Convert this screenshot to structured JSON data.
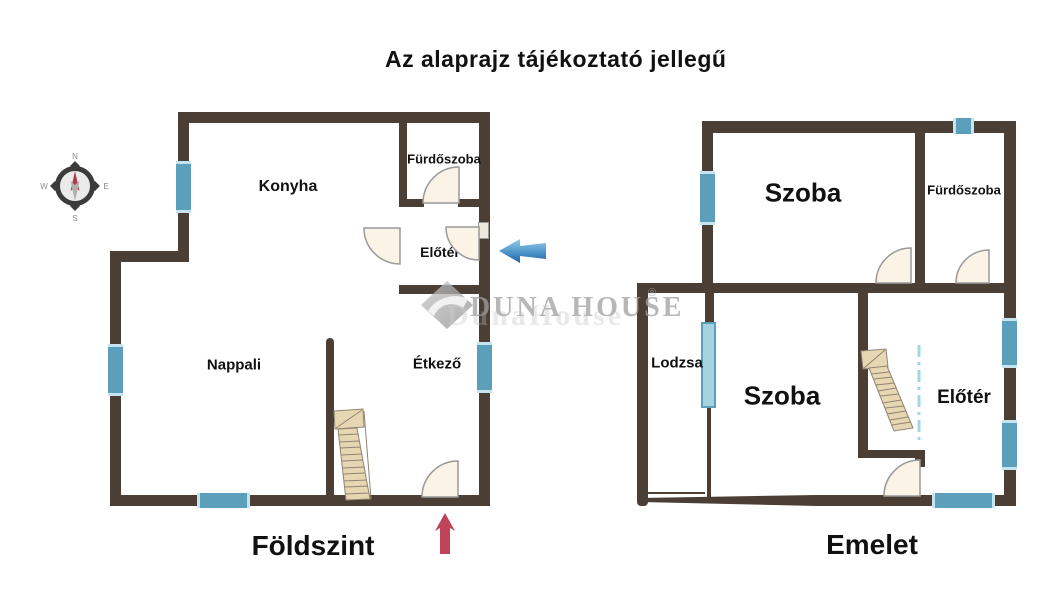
{
  "title": "Az alaprajz tájékoztató jellegű",
  "compass": {
    "north": "N",
    "east": "E",
    "south": "S",
    "west": "W"
  },
  "watermark": {
    "brand": "DUNA HOUSE",
    "reg": "®",
    "ghost": "DunaHouse"
  },
  "floors": [
    {
      "name": "Földszint",
      "rooms": [
        {
          "label": "Konyha"
        },
        {
          "label": "Fürdőszoba"
        },
        {
          "label": "Előtér"
        },
        {
          "label": "Nappali"
        },
        {
          "label": "Étkező"
        }
      ]
    },
    {
      "name": "Emelet",
      "rooms": [
        {
          "label": "Szoba"
        },
        {
          "label": "Fürdőszoba"
        },
        {
          "label": "Lodzsa"
        },
        {
          "label": "Szoba"
        },
        {
          "label": "Előtér"
        }
      ]
    }
  ],
  "colors": {
    "wall": "#4a3e35",
    "window_fill": "#5b9fba",
    "window_edge": "#c6e4ef",
    "window_light": "#a6d3e2",
    "door_fill": "#faf3e6",
    "door_stroke": "#9a9a9a",
    "stair_fill": "#e6d7b2",
    "stair_stroke": "#8f8472",
    "dash_line": "#9fd8e4",
    "arrow_red": "#bf4459",
    "arrow_blue_dark": "#1c64a8",
    "arrow_blue_light": "#8fd0ee",
    "compass_ring": "#3b3b3b",
    "compass_red": "#b23848",
    "text": "#111111",
    "watermark_gray": "#a0a0a0"
  }
}
